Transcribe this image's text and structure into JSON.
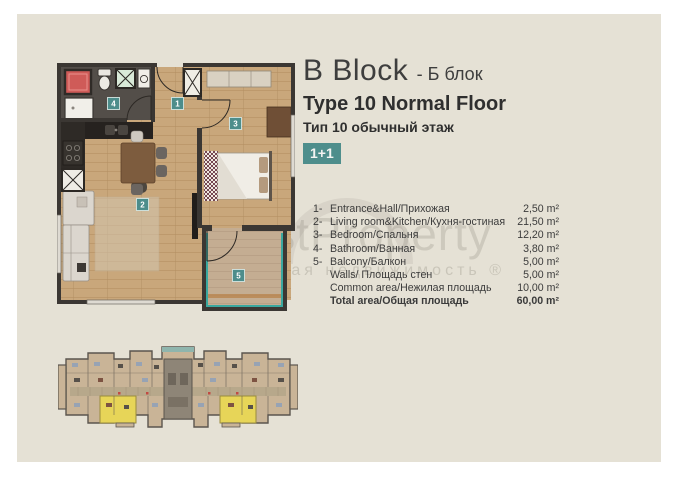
{
  "header": {
    "block_en": "B Block",
    "block_ru": "- Б блок",
    "type_en": "Type 10 Normal Floor",
    "type_ru": "Тип 10 обычный этаж",
    "layout_badge": "1+1"
  },
  "floorplan": {
    "badges": {
      "hall": "1",
      "living": "2",
      "bedroom": "3",
      "bathroom": "4",
      "balcony": "5"
    }
  },
  "area_table": {
    "rows": [
      {
        "num": "1-",
        "label": "Entrance&Hall/Прихожая",
        "value": "2,50 m²"
      },
      {
        "num": "2-",
        "label": "Living room&Kitchen/Кухня-гостиная",
        "value": "21,50 m²"
      },
      {
        "num": "3-",
        "label": "Bedroom/Спальня",
        "value": "12,20 m²"
      },
      {
        "num": "4-",
        "label": "Bathroom/Ванная",
        "value": "3,80 m²"
      },
      {
        "num": "5-",
        "label": "Balcony/Балкон",
        "value": "5,00 m²"
      },
      {
        "num": "",
        "label": "Walls/ Площадь стен",
        "value": "5,00 m²"
      },
      {
        "num": "",
        "label": "Common area/Нежилая площадь",
        "value": "10,00 m²"
      },
      {
        "num": "",
        "label": "Total area/Общая площадь",
        "value": "60,00 m²"
      }
    ]
  },
  "watermark": {
    "brand": "WestProperty",
    "tagline": "зарубежная недвижимость ®"
  },
  "colors": {
    "accent_teal": "#4e8e8c",
    "highlight_yellow": "#e7d558",
    "sheet_beige": "#e5e1d5"
  }
}
